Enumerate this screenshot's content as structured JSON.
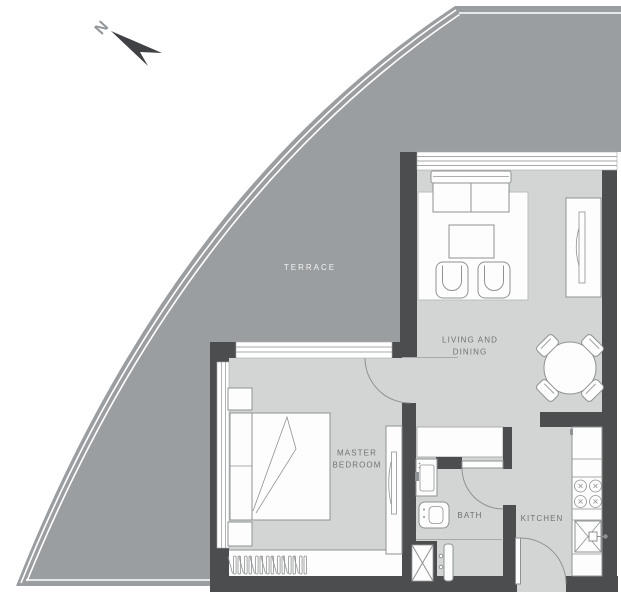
{
  "compass": {
    "north": "N"
  },
  "rooms": {
    "terrace": {
      "label": "TERRACE"
    },
    "living_dining": {
      "line1": "LIVING AND",
      "line2": "DINING"
    },
    "master_bedroom": {
      "line1": "MASTER",
      "line2": "BEDROOM"
    },
    "bath": {
      "label": "BATH"
    },
    "kitchen": {
      "label": "KITCHEN"
    }
  },
  "colors": {
    "background": "#ffffff",
    "terrace_fill": "#9b9ea1",
    "floor_fill": "#d3d5d4",
    "wall_fill": "#4b4d4f",
    "furniture_stroke": "#8f9294",
    "label_color": "#6f7274",
    "terrace_label_color": "#f2f3f3",
    "north_arrow": "#3f4144"
  }
}
